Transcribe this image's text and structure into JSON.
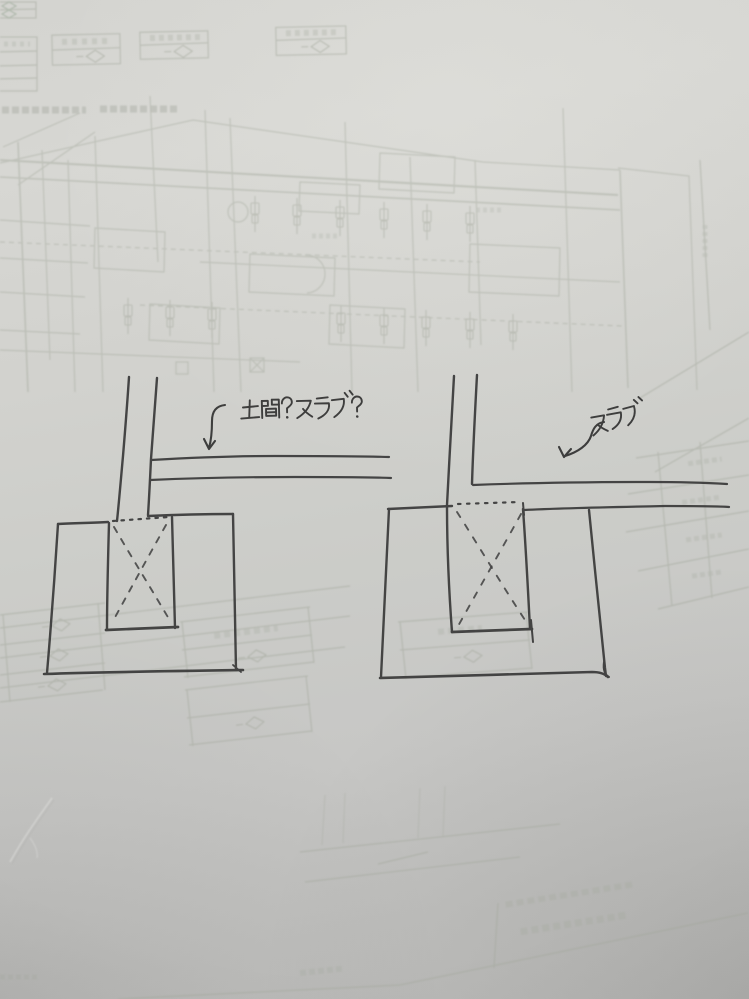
{
  "photo": {
    "kind": "photograph of a paper sheet with a hand-drawn foundation detail sketch",
    "background": "faint blueprint floor plan bleeding through the paper"
  },
  "annotations": {
    "left": {
      "text": "土間？スラブ？",
      "icon": "curved-arrow-down-left"
    },
    "right": {
      "text": "スラブ",
      "icon": "curved-arrow-down-left"
    }
  },
  "sketch": {
    "left_detail": "column + footing section, slab lines separated above footing, dashed X pile in pedestal",
    "right_detail": "column + footing section, slab line meeting footing top, dashed X pile in pedestal"
  },
  "colors": {
    "paper": "#cfcfcb",
    "ink": "#3a3a3a",
    "bleedthrough": "#a2a79b"
  }
}
